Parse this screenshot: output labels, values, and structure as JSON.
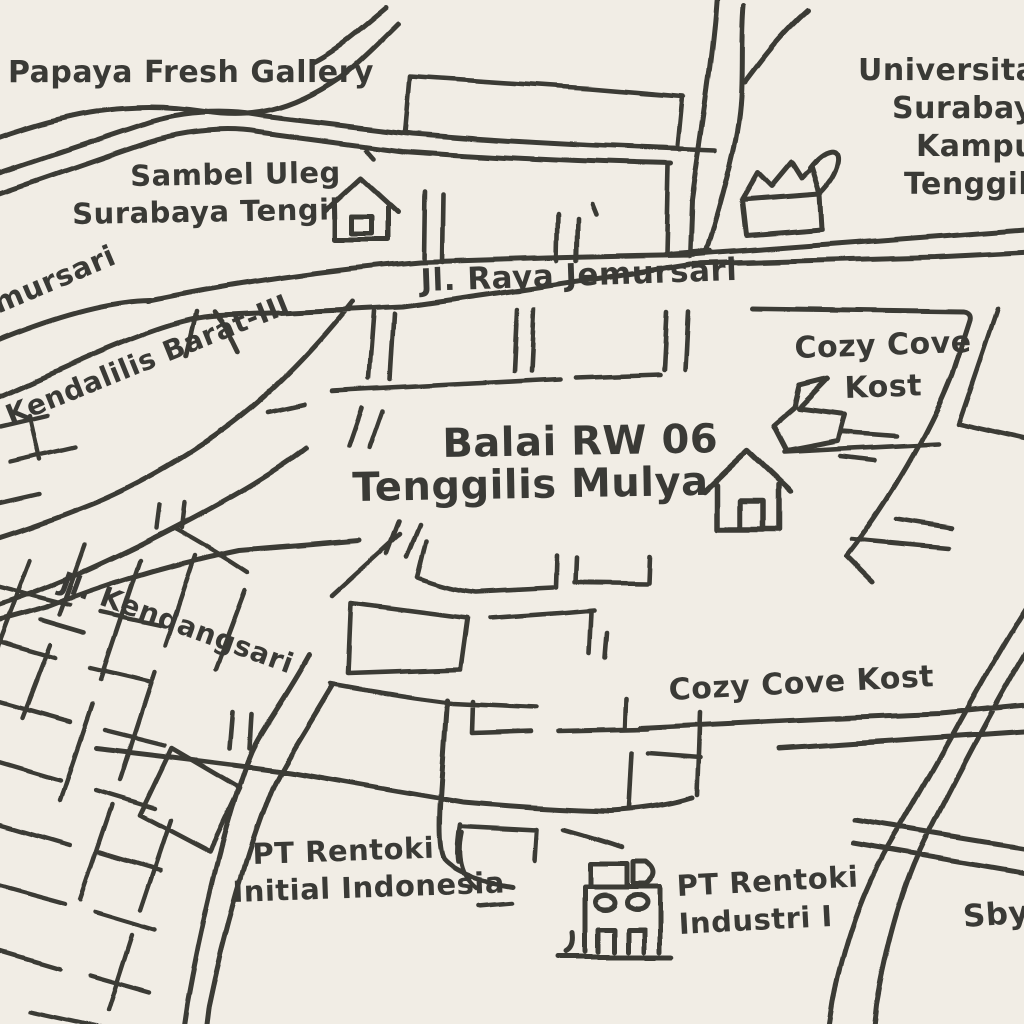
{
  "map": {
    "colors": {
      "background": "#f1ede5",
      "ink": "#3a3a36"
    },
    "labels": {
      "papaya": {
        "text": "Papaya Fresh Gallery"
      },
      "sambel1": {
        "text": "Sambel Uleg"
      },
      "sambel2": {
        "text": "Surabaya Tengil"
      },
      "uni1": {
        "text": "Universitas"
      },
      "uni2": {
        "text": "Surabaya"
      },
      "uni3": {
        "text": "Kampus"
      },
      "uni4": {
        "text": "Tenggilis"
      },
      "jlraya": {
        "text": "Jl. Raya Jemursari"
      },
      "jemursari": {
        "text": "Jemursari"
      },
      "kendalilis": {
        "text": "Kendalilis Barat-III"
      },
      "balai1": {
        "text": "Balai RW 06"
      },
      "balai2": {
        "text": "Tenggilis Mulya"
      },
      "cozy_upper1": {
        "text": "Cozy Cove"
      },
      "cozy_upper2": {
        "text": "Kost"
      },
      "kendangsari": {
        "text": "Jl. Kendangsari"
      },
      "cozy_lower": {
        "text": "Cozy Cove Kost"
      },
      "rentoki_initial1": {
        "text": "PT Rentoki"
      },
      "rentoki_initial2": {
        "text": "Initial Indonesia"
      },
      "rentoki_industri1": {
        "text": "PT Rentoki"
      },
      "rentoki_industri2": {
        "text": "Industri I"
      },
      "sby": {
        "text": "Sby"
      }
    },
    "icons": {
      "sambel_house": "house-icon",
      "balai_house": "house-icon",
      "university_building": "open-box-building-icon",
      "cozy_cove_marker": "arrow-marker-icon",
      "factory": "factory-building-icon"
    }
  }
}
